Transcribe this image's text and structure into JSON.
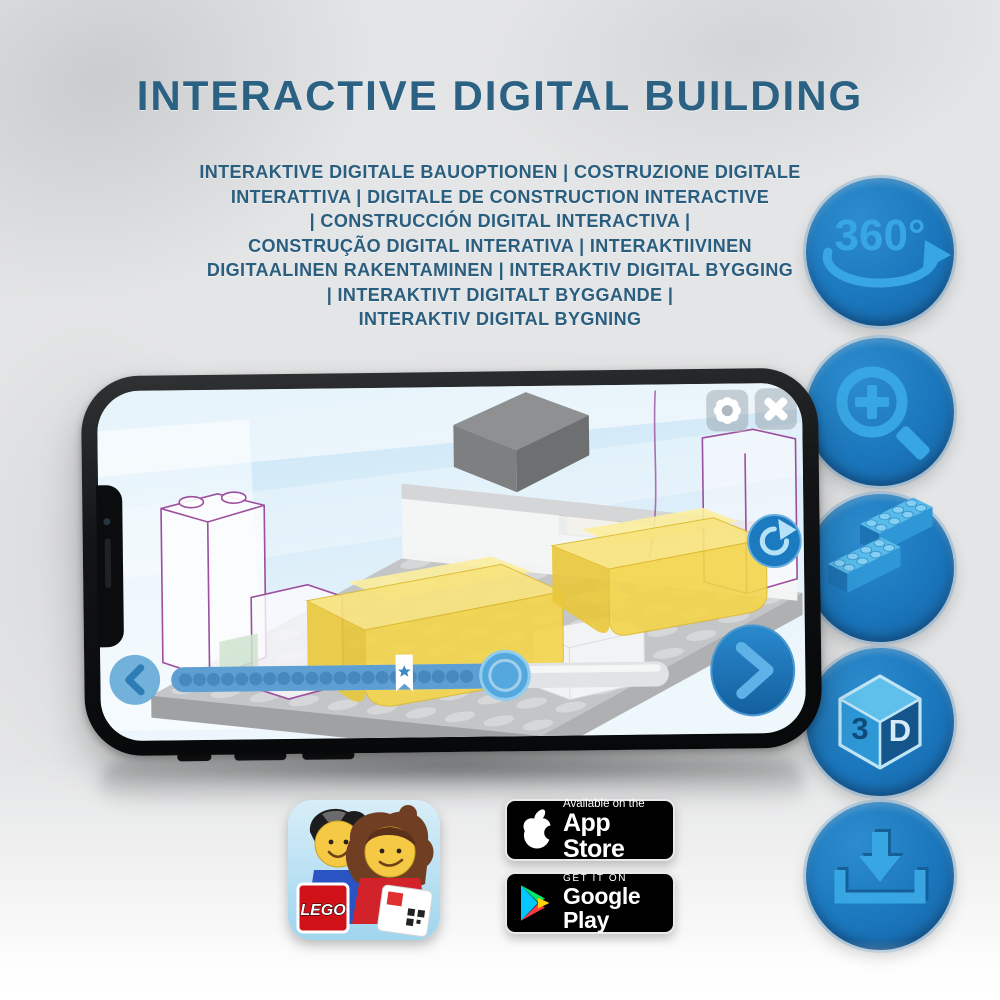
{
  "header": {
    "title": "INTERACTIVE DIGITAL BUILDING",
    "subtitle_lines": [
      "INTERAKTIVE DIGITALE BAUOPTIONEN | COSTRUZIONE DIGITALE",
      "INTERATTIVA | DIGITALE DE CONSTRUCTION INTERACTIVE",
      "| CONSTRUCCIÓN DIGITAL INTERACTIVA |",
      "CONSTRUÇÃO DIGITAL INTERATIVA | INTERAKTIIVINEN",
      "DIGITAALINEN RAKENTAMINEN | INTERAKTIV DIGITAL BYGGING",
      "| INTERAKTIVT DIGITALT BYGGANDE |",
      "INTERAKTIV DIGITAL BYGNING"
    ]
  },
  "feature_rail": {
    "items": [
      {
        "name": "360-degree-rotation",
        "label": "360°"
      },
      {
        "name": "zoom-in-magnifier"
      },
      {
        "name": "stacked-lego-bricks"
      },
      {
        "name": "3d-view-cube",
        "cube_left_face": "3",
        "cube_right_face": "D"
      },
      {
        "name": "download-instructions"
      }
    ]
  },
  "phone": {
    "screen": {
      "toolbar_icons": [
        "settings-gear",
        "close-x"
      ],
      "rotate_icon": "rotate-clockwise-arrow",
      "nav_icons": {
        "back": "chevron-left",
        "next": "chevron-right"
      },
      "progress_bar": {
        "fill_percent": 69,
        "bookmark_at_percent": 47,
        "step_dot_count": 21
      }
    }
  },
  "app_badges": {
    "lego_app_logo_text": "LEGO",
    "app_store": {
      "tagline": "Available on the",
      "store_name": "App Store"
    },
    "google_play": {
      "tagline": "GET IT ON",
      "store_name": "Google Play"
    }
  },
  "colors": {
    "heading_blue": "#2b6183",
    "icon_circle_blue": "#1b77bd",
    "icon_glyph_blue": "#38a6e2",
    "trans_yellow_brick": "#f3d54a",
    "ghost_outline_purple": "#9c4f9e",
    "badge_black": "#000000"
  }
}
